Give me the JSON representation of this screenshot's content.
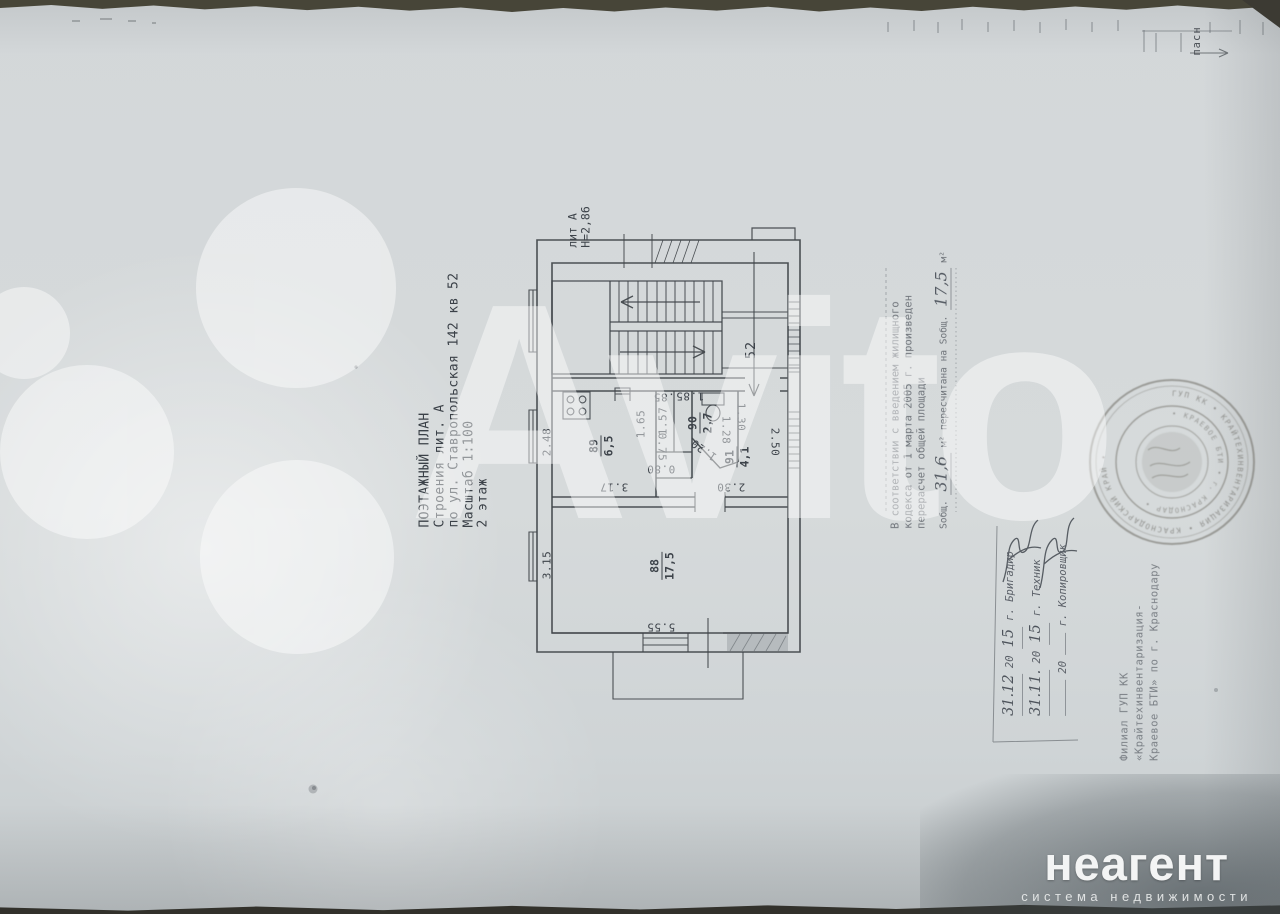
{
  "title_block": {
    "lines": [
      "ПОЭТАЖНЫЙ  ПЛАН",
      "Строения лит. А",
      "по ул. Ставропольская  142 кв 52",
      "Масштаб 1:100",
      "2  этаж"
    ]
  },
  "plan": {
    "building_label": "лит А",
    "height_label": "Н=2,86",
    "apartment_number": "52",
    "edge_label": "пасн",
    "rooms": [
      {
        "number": "88",
        "area": "17,5"
      },
      {
        "number": "89",
        "area": "6,5"
      },
      {
        "number": "90",
        "area": "2,7"
      },
      {
        "number": "91",
        "area": "4,1"
      }
    ],
    "dimensions": {
      "left_kitchen": "2.48",
      "left_living": "3.15",
      "kitchen_w": "1.65",
      "closet_depth": "1.57",
      "closet_w": "0.75",
      "closet2": "0.80",
      "kitchen_len": "3.17",
      "bath_a": ".85",
      "bath_b": "1.85",
      "bath_right": "1.28",
      "bath_diag": "1.20",
      "hall_top": "1.30",
      "hall_right": "2.50",
      "hall_bottom": "2.30",
      "living_w": "5.55"
    }
  },
  "recalc_note": {
    "lines": [
      "В соответствии с введением жилищного",
      "кодекса от 1 марта 2005 г. произведен",
      "перерасчет общей площади"
    ],
    "s_label": "Sобщ.",
    "value1": "31,6",
    "mid_label": "м² пересчитана на Sобщ.",
    "value2": "17,5",
    "unit": "м²"
  },
  "signature_table": {
    "rows": [
      {
        "date": "31.12",
        "c20": "20",
        "yy": "15",
        "role": "г. Бригадир"
      },
      {
        "date": "31.11.",
        "c20": "20",
        "yy": "15",
        "role": "г. Техник"
      },
      {
        "date": "",
        "c20": "20",
        "yy": "",
        "role": "г. Копировщик"
      }
    ]
  },
  "bti_stamp": {
    "lines": [
      "Филиал ГУП КК",
      "«Крайтехинвентаризация-",
      "Краевое БТИ» по г. Краснодару"
    ]
  },
  "seal": {
    "ring_text_outer": "ГУП КК • КРАЙТЕХИНВЕНТАРИЗАЦИЯ • КРАСНОДАРСКИЙ КРАЙ • ",
    "ring_text_inner": "• КРАЕВОЕ БТИ • г. КРАСНОДАР • "
  },
  "watermark": {
    "brand": "Avito"
  },
  "footer_logo": {
    "brand": "неагент",
    "tagline": "система недвижимости"
  }
}
